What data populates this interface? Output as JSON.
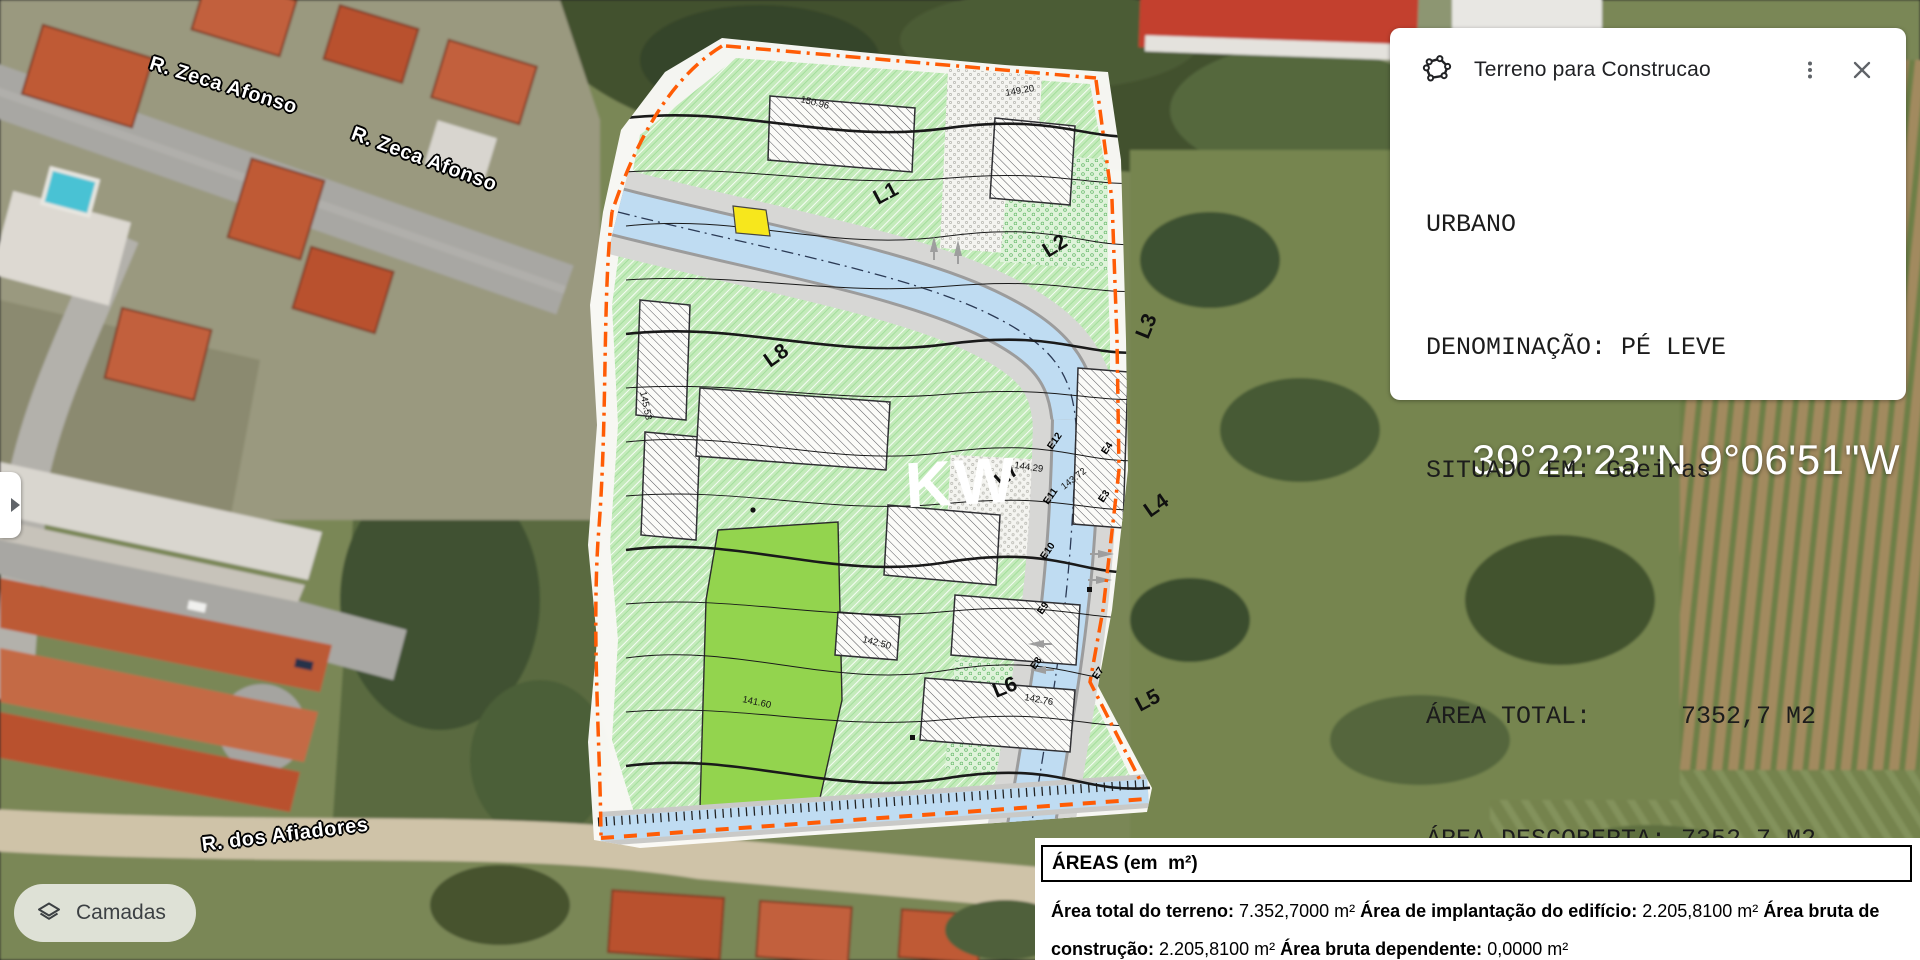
{
  "map": {
    "street_labels": [
      "R. Zeca Afonso",
      "R. Zeca Afonso",
      "R. dos Afiadores"
    ],
    "coordinates": "39°22'23\"N 9°06'51\"W",
    "layers_button_label": "Camadas"
  },
  "info_card": {
    "title": "Terreno para Construcao",
    "type_line": "URBANO",
    "denomination_line": "DENOMINAÇÃO: PÉ LEVE",
    "location_line": "SITUADO EM: Gaeiras",
    "area_total_line": "ÁREA TOTAL:      7352,7 M2",
    "area_descoberta_line": "ÁREA DESCOBERTA: 7352,7 M2"
  },
  "areas_panel": {
    "header": "ÁREAS (em  m²)",
    "fields": [
      {
        "label": "Área total do terreno:",
        "value": "7.352,7000 m²"
      },
      {
        "label": "Área de implantação do edifício:",
        "value": "2.205,8100 m²"
      },
      {
        "label": "Área bruta de construção:",
        "value": "2.205,8100 m²"
      },
      {
        "label": "Área bruta dependente:",
        "value": "0,0000 m²"
      }
    ]
  },
  "plan": {
    "watermark": "KW",
    "lot_labels": [
      "L1",
      "L2",
      "L3",
      "L4",
      "L5",
      "L6",
      "L7",
      "L8"
    ],
    "edge_labels": [
      "E12",
      "E11",
      "E10",
      "E9",
      "E8",
      "E4",
      "E3",
      "E7"
    ],
    "elevation_labels": [
      "150.96",
      "149.20",
      "145.53",
      "144.29",
      "143.72",
      "142.50",
      "141.60",
      "142.76"
    ]
  }
}
